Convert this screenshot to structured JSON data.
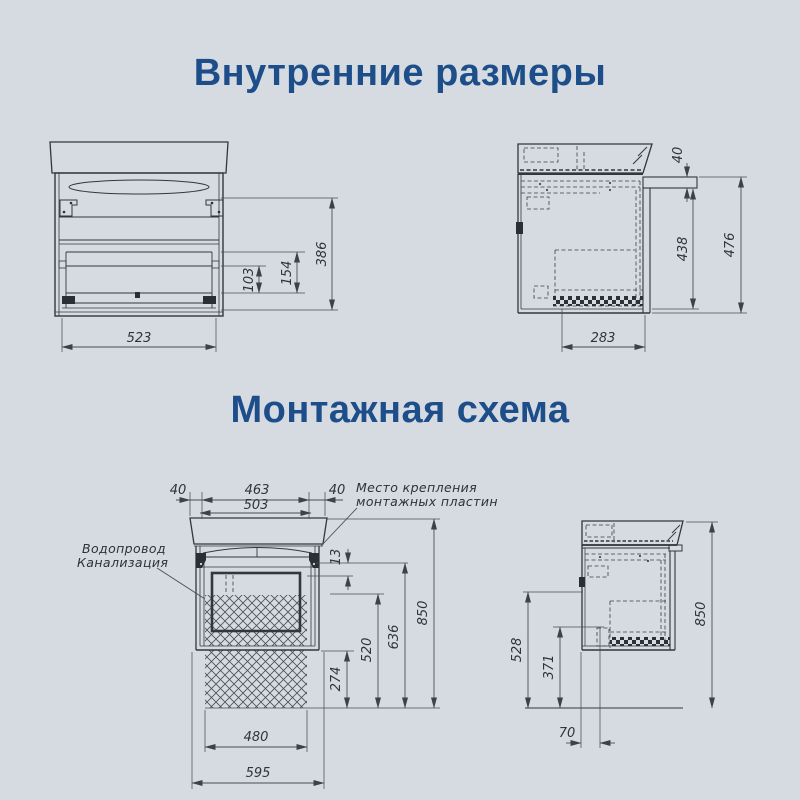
{
  "colors": {
    "background": "#d5dbe1",
    "title": "#1d4e8a",
    "line": "#33373c"
  },
  "titles": {
    "internal_dimensions": "Внутренние размеры",
    "mounting_scheme": "Монтажная схема"
  },
  "internal_front_view": {
    "dims": {
      "inner_width": "523",
      "lower_drawer_height": "103",
      "drawer_height": "154",
      "inner_height": "386"
    }
  },
  "internal_side_view": {
    "dims": {
      "top_rim_height": "40",
      "body_height": "438",
      "total_height": "476",
      "inner_depth": "283"
    }
  },
  "mounting_front_view": {
    "labels": {
      "mounting_plates_line1": "Место крепления",
      "mounting_plates_line2": "монтажных пластин",
      "plumbing_line1": "Водопровод",
      "plumbing_line2": "Канализация"
    },
    "dims": {
      "left_plate_offset": "40",
      "plates_inner_span": "463",
      "right_plate_offset": "40",
      "plates_outer_span": "503",
      "plate_gap": "13",
      "bottom_clearance": "274",
      "niche_height": "520",
      "plates_height": "636",
      "total_height": "850",
      "niche_width": "480",
      "total_width": "595"
    }
  },
  "mounting_side_view": {
    "dims": {
      "drain_height": "528",
      "supply_height": "371",
      "wall_offset": "70",
      "total_height": "850"
    }
  }
}
